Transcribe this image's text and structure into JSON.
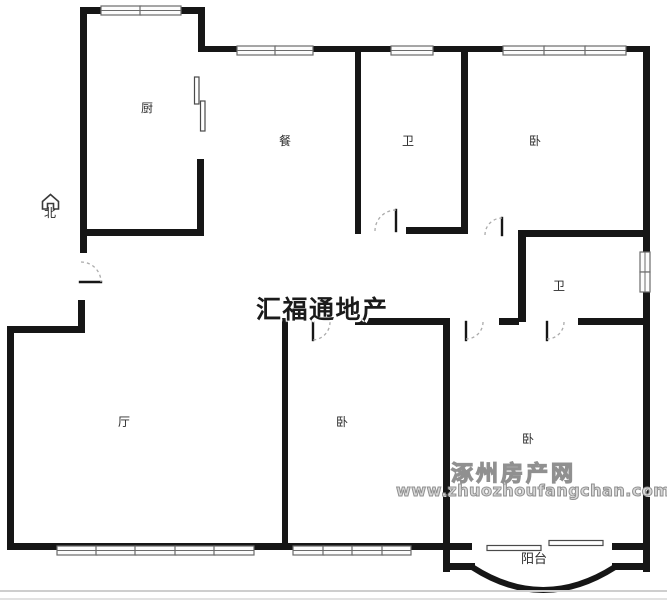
{
  "compass": {
    "label": "北",
    "icon": "north-house-arrow"
  },
  "rooms": {
    "kitchen": "厨",
    "dining": "餐",
    "bath_top": "卫",
    "bedroom_top_right": "卧",
    "bath_mid": "卫",
    "living": "厅",
    "bedroom_mid": "卧",
    "bedroom_bottom_right": "卧",
    "balcony": "阳台"
  },
  "watermarks": {
    "agency": "汇福通地产",
    "site_name": "涿州房产网",
    "site_url": "www.zhuozhoufangchan.com"
  },
  "colors": {
    "wall": "#161616",
    "watermark_agency": "#1b1b1b",
    "watermark_site": "#979797",
    "background": "#ffffff"
  }
}
